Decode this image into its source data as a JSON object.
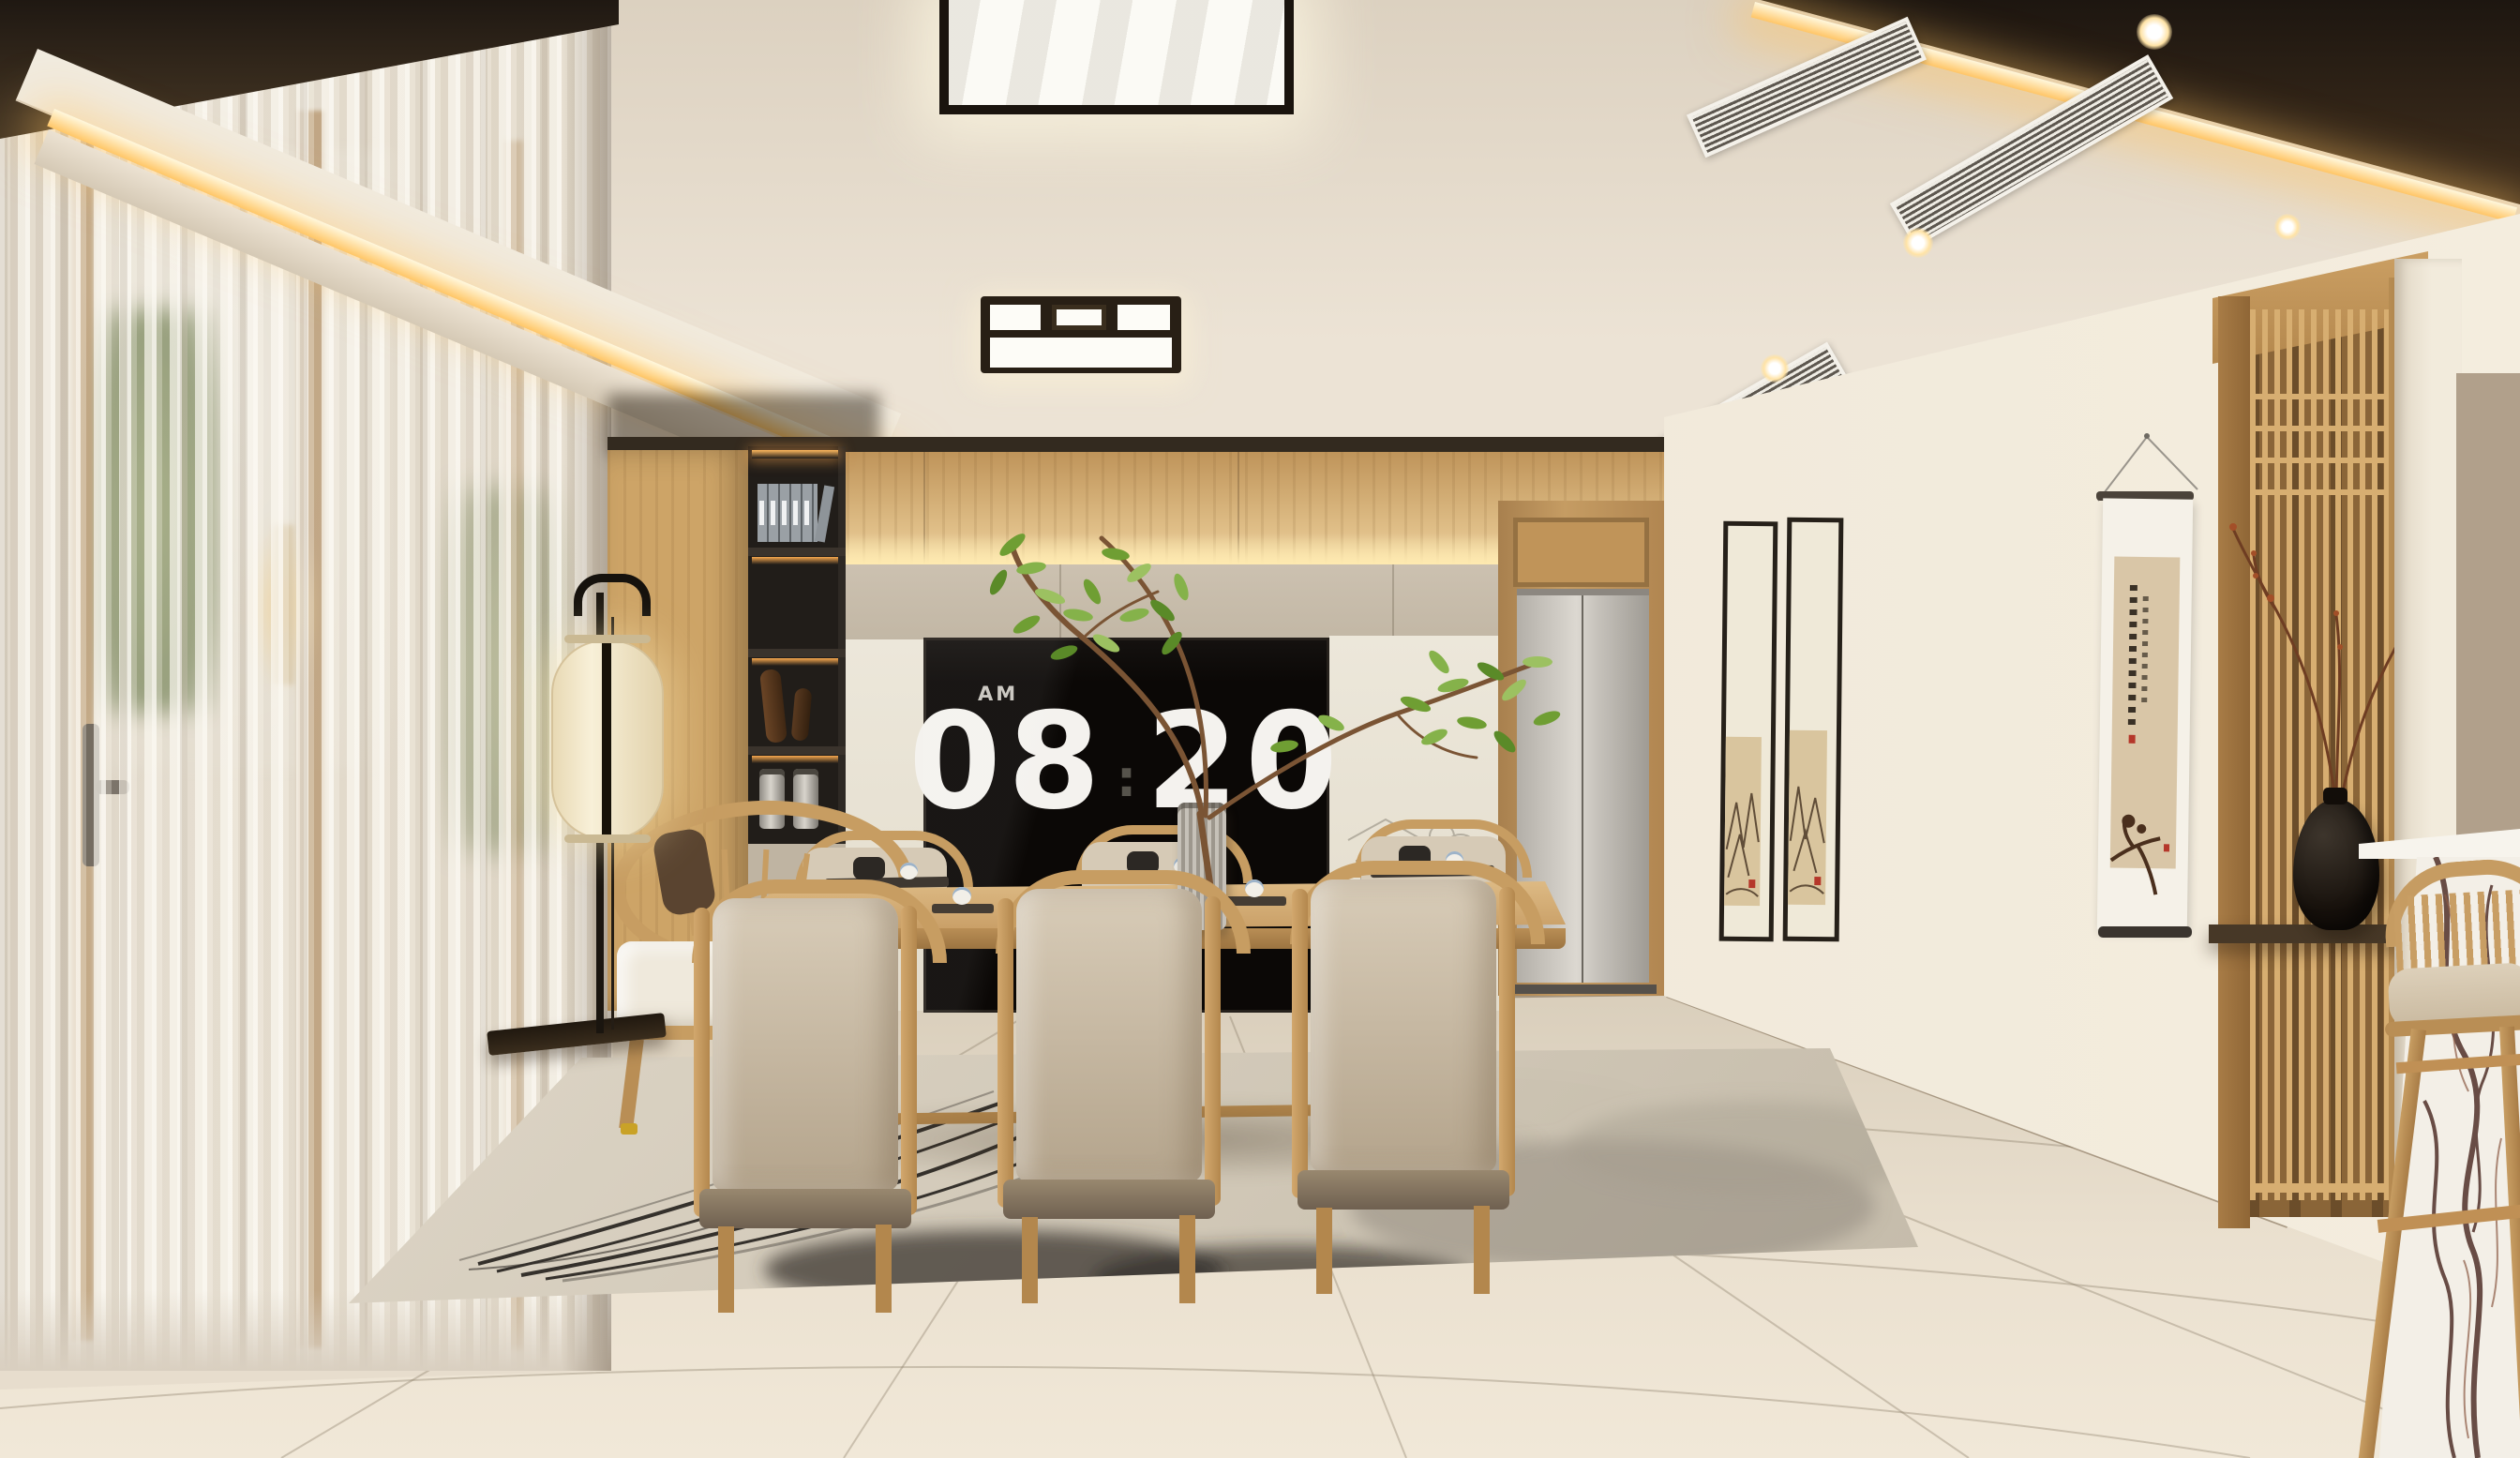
{
  "scene": {
    "description": "Photorealistic render of a modern Japandi dining room at morning: wooden dining table with six beige-cushioned chairs, large black wall screen showing a flip clock, cove-lit ceiling, sheer curtains, hanging scroll, wooden lattice screen with black vase, marble bar counter with wooden stool, ink-wash area rug.",
    "flip_clock": {
      "meridiem": "AM",
      "hours": "08",
      "minutes": "20",
      "separator": ":"
    },
    "palette": {
      "wall_cream": "#ece4d6",
      "ceiling_cream": "#e7ddcd",
      "cove_glow": "#ffd27a",
      "dark_ceiling_band": "#241c14",
      "wood_light": "#d2a96b",
      "wood_dark": "#a87c46",
      "beige_panel": "#c6bbaa",
      "screen_black": "#0b0806",
      "clock_digits": "#f4f2ee",
      "cushion_beige": "#cfc2ad",
      "curtain_sheer": "#efe9dd",
      "elevator_door": "#c9c5be",
      "lattice_wood": "#d7ae71",
      "vase_black": "#17100b",
      "leaf_green": "#7aa93c",
      "marble_white": "#f3efe7",
      "marble_vein": "#53342c",
      "rug_base": "#d3cab9",
      "rug_ink": "#35312c",
      "floor_tile": "#e8decd"
    }
  }
}
